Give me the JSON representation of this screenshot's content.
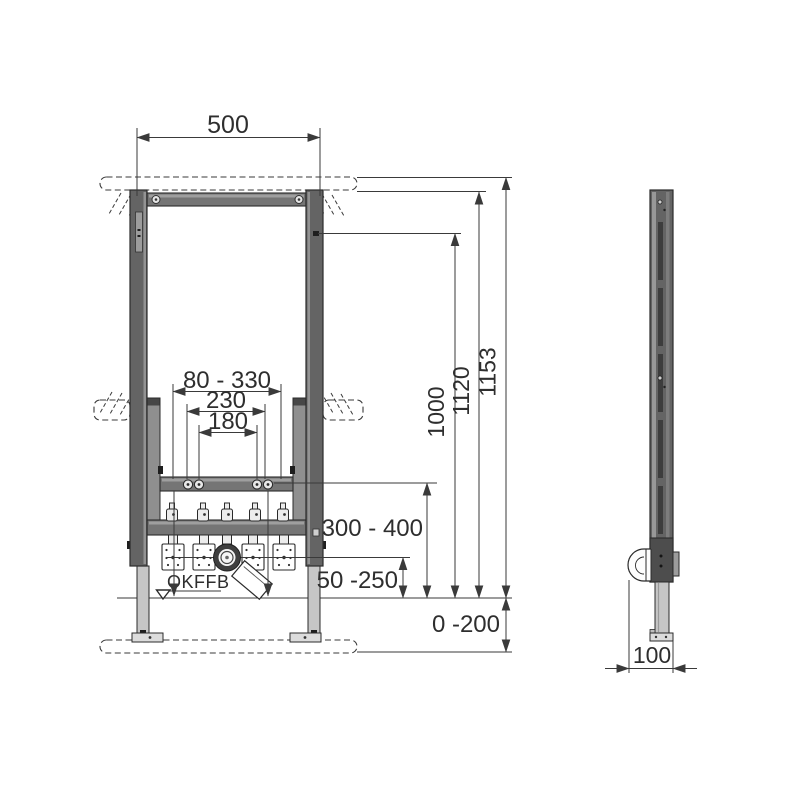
{
  "drawing": {
    "front_view": {
      "top_width": "500",
      "fixing_range": "80 - 330",
      "fixing_outer": "230",
      "fixing_inner": "180",
      "height_inner": "1000",
      "height_mid": "1120",
      "height_total": "1153",
      "crossbar_height": "300 - 400",
      "outlet_height": "50 -250",
      "floor_range": "0 -200",
      "floor_level_label": "OKFFB"
    },
    "side_view": {
      "depth": "100"
    }
  }
}
